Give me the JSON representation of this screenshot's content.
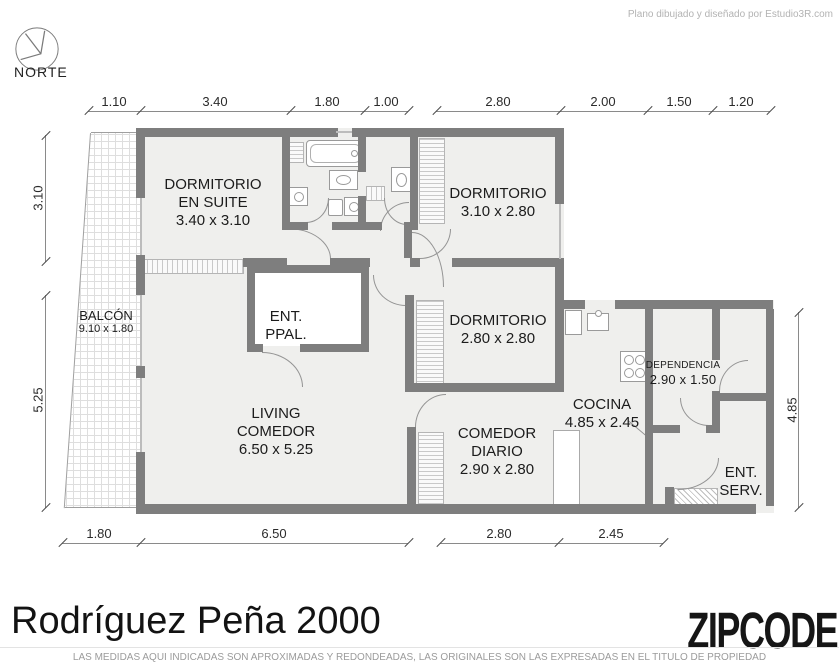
{
  "header": {
    "credit": "Plano dibujado y diseñado por Estudio3R.com",
    "compass": "NORTE"
  },
  "rooms": {
    "dormitorio_suite": {
      "name": "DORMITORIO",
      "name2": "EN SUITE",
      "size": "3.40 x 3.10"
    },
    "dormitorio_norte": {
      "name": "DORMITORIO",
      "size": "3.10 x 2.80"
    },
    "dormitorio_centro": {
      "name": "DORMITORIO",
      "size": "2.80 x 2.80"
    },
    "ent_ppal": {
      "name": "ENT.",
      "name2": "PPAL."
    },
    "living_comedor": {
      "name": "LIVING",
      "name2": "COMEDOR",
      "size": "6.50 x 5.25"
    },
    "comedor_diario": {
      "name": "COMEDOR",
      "name2": "DIARIO",
      "size": "2.90 x 2.80"
    },
    "cocina": {
      "name": "COCINA",
      "size": "4.85 x 2.45"
    },
    "dependencia": {
      "name": "DEPENDENCIA",
      "size": "2.90 x 1.50"
    },
    "ent_serv": {
      "name": "ENT.",
      "name2": "SERV."
    },
    "balcon": {
      "name": "BALCÓN",
      "size": "9.10 x 1.80"
    }
  },
  "dimensions": {
    "top": [
      "1.10",
      "3.40",
      "1.80",
      "1.00",
      "2.80",
      "2.00",
      "1.50",
      "1.20"
    ],
    "bottom": [
      "1.80",
      "6.50",
      "2.80",
      "2.45"
    ],
    "left": [
      "3.10",
      "5.25"
    ],
    "right": [
      "4.85"
    ]
  },
  "footer": {
    "title": "Rodríguez Peña 2000",
    "brand": "ZIPCODE",
    "disclaimer": "LAS MEDIDAS AQUI INDICADAS SON APROXIMADAS Y REDONDEADAS, LAS ORIGINALES SON LAS EXPRESADAS EN EL TITULO DE PROPIEDAD"
  },
  "colors": {
    "wall": "#7e7e7e",
    "room_fill": "#efefed"
  }
}
